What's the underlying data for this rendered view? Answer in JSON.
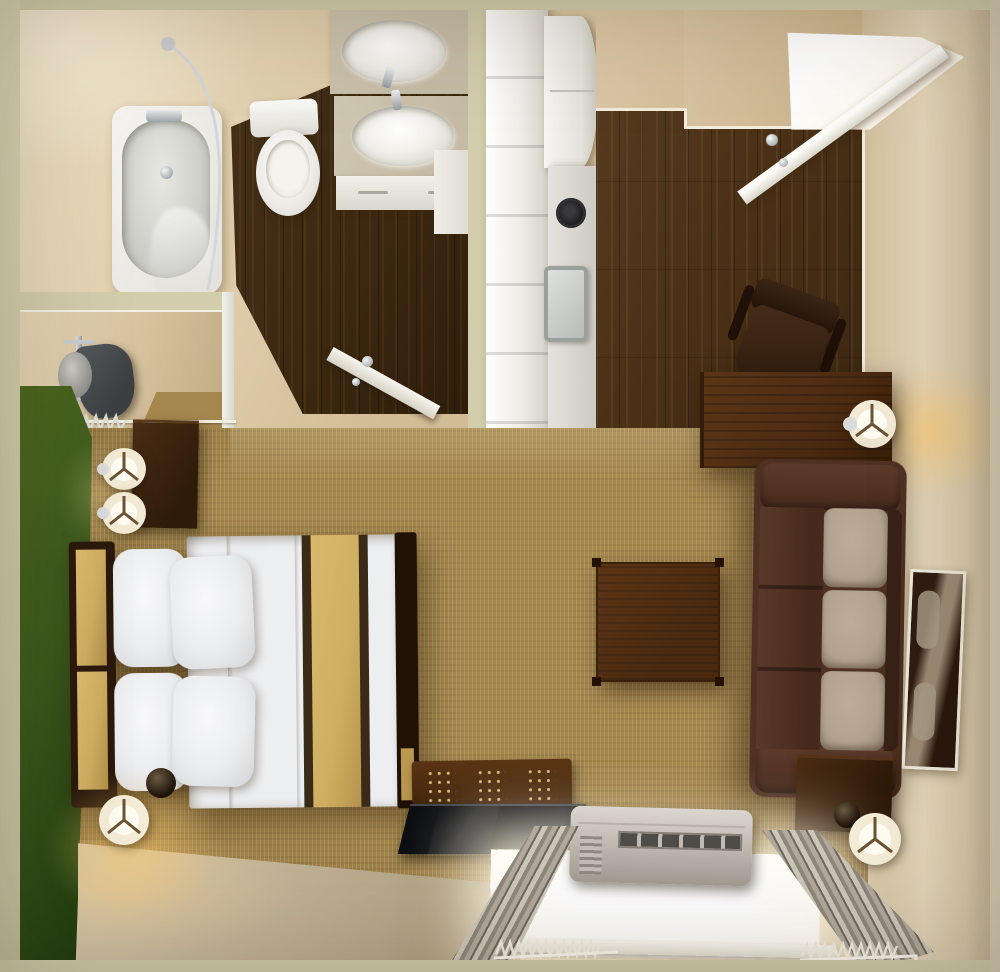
{
  "scene": {
    "title": "studio-suite-3d-floor-plan-top-view",
    "rooms": [
      {
        "name": "bathroom",
        "features": [
          "bathtub",
          "shower-rod",
          "shower-curtain",
          "toilet",
          "double-sink-vanity",
          "vanity-cabinet",
          "open-door",
          "dark-wood-floor"
        ]
      },
      {
        "name": "closet",
        "features": [
          "ironing-board",
          "iron",
          "hanging-rail",
          "wire-hangers"
        ]
      },
      {
        "name": "kitchenette",
        "features": [
          "tall-white-cabinets",
          "refrigerator",
          "countertop",
          "stove-burner",
          "steel-sink"
        ]
      },
      {
        "name": "entry",
        "features": [
          "open-entry-door",
          "bright-doorway",
          "door-knob",
          "wood-floor"
        ]
      },
      {
        "name": "work-area",
        "features": [
          "wood-desk",
          "office-chair",
          "desk-lamp"
        ]
      },
      {
        "name": "living-area",
        "features": [
          "three-seat-sofa",
          "tan-seat-cushions",
          "square-coffee-table",
          "wall-mirror",
          "end-table",
          "floor-lamp"
        ]
      },
      {
        "name": "sleeping-area",
        "features": [
          "bed-with-white-duvet",
          "gold-runner-stripe",
          "four-pillows",
          "headboard-gold-panels",
          "footboard",
          "nightstand",
          "two-drum-lamps",
          "floor-lamp",
          "green-accent-wall"
        ]
      },
      {
        "name": "window-wall",
        "features": [
          "tv-bench",
          "flat-tv",
          "ptac-air-conditioner",
          "bright-window",
          "white-sill",
          "pleated-curtains",
          "curtain-hooks"
        ]
      }
    ]
  },
  "palette": {
    "cutWall": "#d2cdab",
    "wall": "#dcc8a5",
    "wallLight": "#ecdfc2",
    "woodDark": "#3c2810",
    "wood": "#4a3016",
    "carpet": "#a5874e",
    "green": "#3c5a1d",
    "greenDark": "#1d3a0e",
    "counterGrey": "#c6bca6",
    "furnWood": "#4e2c13",
    "gold": "#cfae62",
    "bedWhite": "#edeef0",
    "sofaBrown": "#4e3123",
    "cushionTan": "#b2a28f",
    "tvBlack": "#101114",
    "glow": "rgba(255,196,96,0.55)",
    "windowLight": "#fffdf4"
  }
}
